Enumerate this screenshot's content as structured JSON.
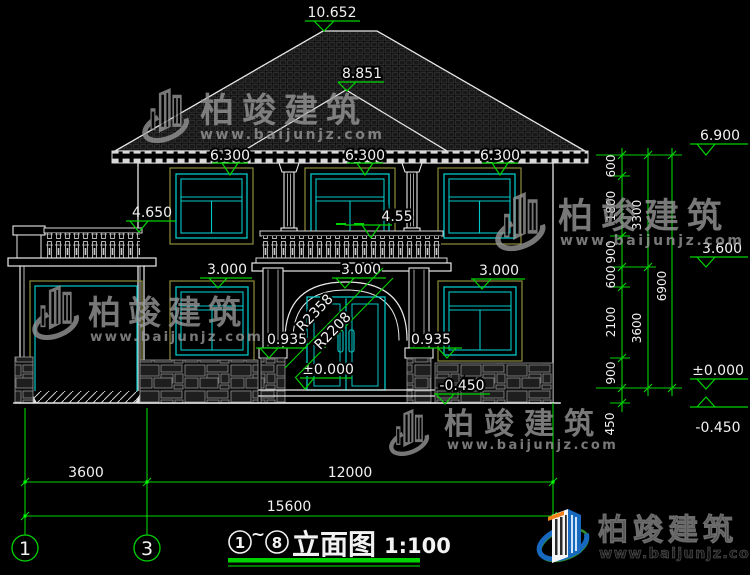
{
  "drawing": {
    "elevation_labels": {
      "ridge": "10.652",
      "front_hip": "8.851",
      "eave": "6.300",
      "terrace_rail": "4.650",
      "balcony_rail": "4.55",
      "window_head": "3.000",
      "pedestal_top": "0.935",
      "floor_zero": "±0.000",
      "ground": "-0.450",
      "right_eave": "6.900",
      "right_floor2": "3.600"
    },
    "arch_radii": {
      "outer": "R2358",
      "inner": "R2208"
    },
    "right_dims": {
      "segments": [
        "600",
        "1800",
        "900",
        "600",
        "2100",
        "900",
        "450"
      ],
      "story": [
        "3300",
        "3600"
      ],
      "total": "6900"
    },
    "bottom_dims": {
      "left": "3600",
      "right": "12000",
      "total": "15600"
    },
    "grid_bubbles": {
      "left": "1",
      "right": "3"
    }
  },
  "title_block": {
    "axis_start": "1",
    "tilde": "~",
    "axis_end": "8",
    "name": "立面图",
    "scale": "1:100"
  },
  "watermark": {
    "brand": "柏竣建筑",
    "site": "www.baijunjz.com"
  },
  "footer_logo": {
    "brand": "柏竣建筑",
    "site": "www.baijunjz.com"
  },
  "colors": {
    "dim_green": "#00d400",
    "cad_white": "#e8e8e8",
    "window_cyan": "#00c9c9",
    "frame_olive": "#8f8f3d"
  }
}
